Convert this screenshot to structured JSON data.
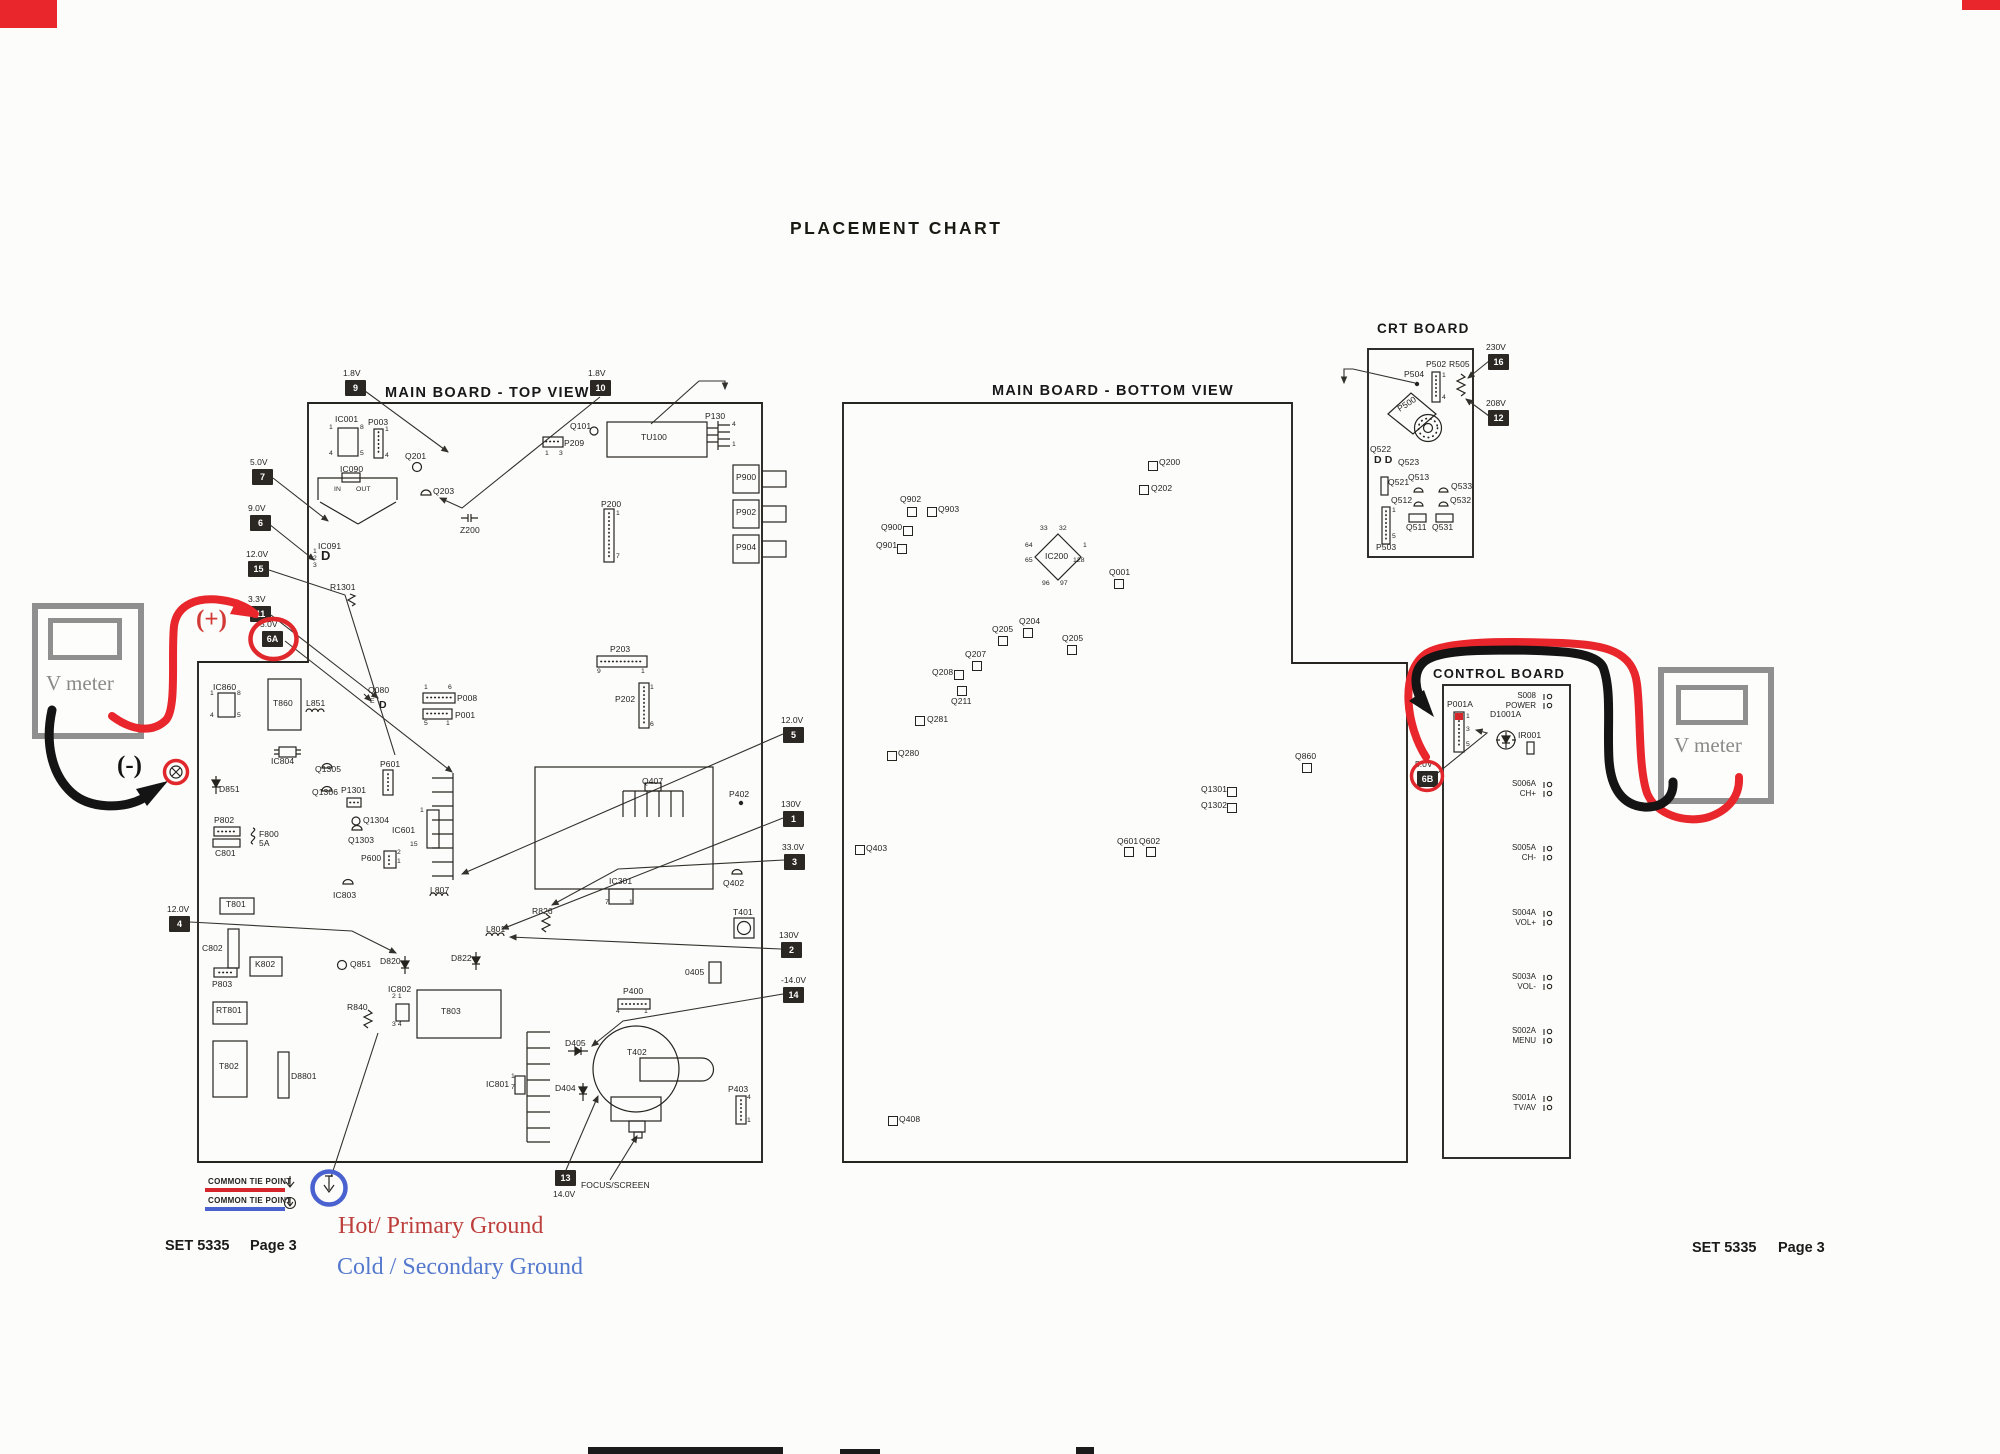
{
  "page": {
    "title": "PLACEMENT CHART",
    "annotations": {
      "plus": "(+)",
      "minus": "(-)"
    },
    "v_meters": {
      "left": "V meter",
      "right": "V meter"
    },
    "legend": {
      "common_tie_hot": "COMMON TIE POINT",
      "common_tie_cold": "COMMON TIE POINT",
      "hot_ground": "Hot/ Primary Ground",
      "cold_ground": "Cold / Secondary Ground"
    },
    "footer_left": {
      "set": "SET 5335",
      "page": "Page 3"
    },
    "footer_right": {
      "set": "SET 5335",
      "page": "Page 3"
    }
  },
  "colors": {
    "red": "#e0282c",
    "blue": "#4a62cf",
    "ink": "#26241f",
    "gray": "#8f8f8f"
  },
  "test_points": [
    {
      "id": "9",
      "v": "1.8V",
      "x": 345,
      "y": 380
    },
    {
      "id": "10",
      "v": "1.8V",
      "x": 590,
      "y": 380
    },
    {
      "id": "7",
      "v": "5.0V",
      "x": 252,
      "y": 469
    },
    {
      "id": "6",
      "v": "9.0V",
      "x": 250,
      "y": 515
    },
    {
      "id": "15",
      "v": "12.0V",
      "x": 248,
      "y": 561
    },
    {
      "id": "11",
      "v": "3.3V",
      "x": 250,
      "y": 606
    },
    {
      "id": "6A",
      "v": "5.0V",
      "x": 262,
      "y": 631
    },
    {
      "id": "4",
      "v": "12.0V",
      "x": 169,
      "y": 916
    },
    {
      "id": "5",
      "v": "12.0V",
      "x": 783,
      "y": 727
    },
    {
      "id": "1",
      "v": "130V",
      "x": 783,
      "y": 811
    },
    {
      "id": "3",
      "v": "33.0V",
      "x": 784,
      "y": 854
    },
    {
      "id": "2",
      "v": "130V",
      "x": 781,
      "y": 942
    },
    {
      "id": "14",
      "v": "-14.0V",
      "x": 783,
      "y": 987
    },
    {
      "id": "13",
      "v": "14.0V",
      "x": 555,
      "y": 1170,
      "below": true
    },
    {
      "id": "16",
      "v": "230V",
      "x": 1488,
      "y": 354
    },
    {
      "id": "12",
      "v": "208V",
      "x": 1488,
      "y": 410
    },
    {
      "id": "6B",
      "v": "5.0V",
      "x": 1417,
      "y": 771
    }
  ],
  "top_board": {
    "title": "MAIN BOARD - TOP VIEW",
    "labels": [
      {
        "t": "IC001",
        "x": 335,
        "y": 415
      },
      {
        "t": "P003",
        "x": 368,
        "y": 418
      },
      {
        "t": "IC090",
        "x": 340,
        "y": 465
      },
      {
        "t": "IN",
        "x": 334,
        "y": 486,
        "c": "pin"
      },
      {
        "t": "OUT",
        "x": 356,
        "y": 486,
        "c": "pin"
      },
      {
        "t": "Q201",
        "x": 405,
        "y": 452
      },
      {
        "t": "Q203",
        "x": 433,
        "y": 487
      },
      {
        "t": "Z200",
        "x": 460,
        "y": 526
      },
      {
        "t": "IC091",
        "x": 318,
        "y": 542
      },
      {
        "t": "D",
        "x": 321,
        "y": 549,
        "c": "d13"
      },
      {
        "t": "Q101",
        "x": 570,
        "y": 422
      },
      {
        "t": "P209",
        "x": 564,
        "y": 439
      },
      {
        "t": "TU100",
        "x": 641,
        "y": 433
      },
      {
        "t": "P130",
        "x": 705,
        "y": 412
      },
      {
        "t": "P900",
        "x": 736,
        "y": 473
      },
      {
        "t": "P902",
        "x": 736,
        "y": 508
      },
      {
        "t": "P904",
        "x": 736,
        "y": 543
      },
      {
        "t": "P200",
        "x": 601,
        "y": 500
      },
      {
        "t": "P203",
        "x": 610,
        "y": 645
      },
      {
        "t": "P202",
        "x": 615,
        "y": 695
      },
      {
        "t": "P008",
        "x": 457,
        "y": 694
      },
      {
        "t": "P001",
        "x": 455,
        "y": 711
      },
      {
        "t": "Q080",
        "x": 368,
        "y": 686
      },
      {
        "t": "D",
        "x": 379,
        "y": 700,
        "c": "d11"
      },
      {
        "t": "E",
        "x": 370,
        "y": 698,
        "c": "pin"
      },
      {
        "t": "R1301",
        "x": 330,
        "y": 583
      },
      {
        "t": "IC860",
        "x": 213,
        "y": 683
      },
      {
        "t": "T860",
        "x": 273,
        "y": 699
      },
      {
        "t": "L851",
        "x": 306,
        "y": 699
      },
      {
        "t": "IC804",
        "x": 271,
        "y": 757
      },
      {
        "t": "Q1305",
        "x": 315,
        "y": 765
      },
      {
        "t": "Q1306",
        "x": 312,
        "y": 788
      },
      {
        "t": "P1301",
        "x": 341,
        "y": 786
      },
      {
        "t": "Q1304",
        "x": 363,
        "y": 816
      },
      {
        "t": "Q1303",
        "x": 348,
        "y": 836
      },
      {
        "t": "IC601",
        "x": 392,
        "y": 826
      },
      {
        "t": "P601",
        "x": 380,
        "y": 760
      },
      {
        "t": "P600",
        "x": 361,
        "y": 854
      },
      {
        "t": "IC803",
        "x": 333,
        "y": 891
      },
      {
        "t": "L807",
        "x": 430,
        "y": 886
      },
      {
        "t": "T801",
        "x": 226,
        "y": 900
      },
      {
        "t": "D851",
        "x": 219,
        "y": 785
      },
      {
        "t": "P802",
        "x": 214,
        "y": 816
      },
      {
        "t": "F800",
        "x": 259,
        "y": 830
      },
      {
        "t": "5A",
        "x": 259,
        "y": 839
      },
      {
        "t": "C801",
        "x": 215,
        "y": 849
      },
      {
        "t": "C802",
        "x": 202,
        "y": 944
      },
      {
        "t": "K802",
        "x": 255,
        "y": 960
      },
      {
        "t": "P803",
        "x": 212,
        "y": 980
      },
      {
        "t": "RT801",
        "x": 216,
        "y": 1006
      },
      {
        "t": "T802",
        "x": 219,
        "y": 1062
      },
      {
        "t": "D8801",
        "x": 291,
        "y": 1072
      },
      {
        "t": "Q851",
        "x": 350,
        "y": 960
      },
      {
        "t": "D820",
        "x": 380,
        "y": 957
      },
      {
        "t": "D822",
        "x": 451,
        "y": 954
      },
      {
        "t": "IC802",
        "x": 388,
        "y": 985
      },
      {
        "t": "T803",
        "x": 441,
        "y": 1007
      },
      {
        "t": "R840",
        "x": 347,
        "y": 1003
      },
      {
        "t": "L801",
        "x": 486,
        "y": 925
      },
      {
        "t": "R826",
        "x": 532,
        "y": 907
      },
      {
        "t": "IC801",
        "x": 486,
        "y": 1080
      },
      {
        "t": "D404",
        "x": 555,
        "y": 1084
      },
      {
        "t": "D405",
        "x": 565,
        "y": 1039
      },
      {
        "t": "T402",
        "x": 627,
        "y": 1048
      },
      {
        "t": "P400",
        "x": 623,
        "y": 987
      },
      {
        "t": "P403",
        "x": 728,
        "y": 1085
      },
      {
        "t": "0405",
        "x": 685,
        "y": 968
      },
      {
        "t": "Q402",
        "x": 723,
        "y": 879
      },
      {
        "t": "Q407",
        "x": 642,
        "y": 777
      },
      {
        "t": "IC301",
        "x": 609,
        "y": 877
      },
      {
        "t": "P402",
        "x": 729,
        "y": 790
      },
      {
        "t": "T401",
        "x": 733,
        "y": 908
      },
      {
        "t": "FOCUS/SCREEN",
        "x": 581,
        "y": 1181
      }
    ],
    "pins": [
      {
        "t": "1",
        "x": 329,
        "y": 424
      },
      {
        "t": "8",
        "x": 360,
        "y": 424
      },
      {
        "t": "4",
        "x": 329,
        "y": 450
      },
      {
        "t": "5",
        "x": 360,
        "y": 450
      },
      {
        "t": "1",
        "x": 385,
        "y": 426
      },
      {
        "t": "4",
        "x": 385,
        "y": 452
      },
      {
        "t": "1",
        "x": 313,
        "y": 548
      },
      {
        "t": "2",
        "x": 313,
        "y": 555
      },
      {
        "t": "3",
        "x": 313,
        "y": 562
      },
      {
        "t": "1",
        "x": 545,
        "y": 450
      },
      {
        "t": "3",
        "x": 559,
        "y": 450
      },
      {
        "t": "4",
        "x": 732,
        "y": 421
      },
      {
        "t": "1",
        "x": 732,
        "y": 441
      },
      {
        "t": "1",
        "x": 616,
        "y": 510
      },
      {
        "t": "7",
        "x": 616,
        "y": 553
      },
      {
        "t": "9",
        "x": 597,
        "y": 668
      },
      {
        "t": "1",
        "x": 641,
        "y": 668
      },
      {
        "t": "1",
        "x": 650,
        "y": 684
      },
      {
        "t": "6",
        "x": 650,
        "y": 721
      },
      {
        "t": "1",
        "x": 424,
        "y": 684
      },
      {
        "t": "6",
        "x": 448,
        "y": 684
      },
      {
        "t": "5",
        "x": 424,
        "y": 720
      },
      {
        "t": "1",
        "x": 446,
        "y": 720
      },
      {
        "t": "1",
        "x": 210,
        "y": 690
      },
      {
        "t": "8",
        "x": 237,
        "y": 690
      },
      {
        "t": "4",
        "x": 210,
        "y": 712
      },
      {
        "t": "5",
        "x": 237,
        "y": 712
      },
      {
        "t": "1",
        "x": 420,
        "y": 807
      },
      {
        "t": "15",
        "x": 410,
        "y": 841
      },
      {
        "t": "2",
        "x": 397,
        "y": 849
      },
      {
        "t": "1",
        "x": 397,
        "y": 858
      },
      {
        "t": "2 1",
        "x": 392,
        "y": 993
      },
      {
        "t": "3 4",
        "x": 392,
        "y": 1021
      },
      {
        "t": "1",
        "x": 511,
        "y": 1073
      },
      {
        "t": "7",
        "x": 511,
        "y": 1084
      },
      {
        "t": "7",
        "x": 605,
        "y": 899
      },
      {
        "t": "1",
        "x": 629,
        "y": 899
      },
      {
        "t": "4",
        "x": 616,
        "y": 1008
      },
      {
        "t": "1",
        "x": 644,
        "y": 1008
      },
      {
        "t": "4",
        "x": 747,
        "y": 1094
      },
      {
        "t": "1",
        "x": 747,
        "y": 1117
      }
    ]
  },
  "bottom_board": {
    "title": "MAIN BOARD - BOTTOM VIEW",
    "parts": [
      {
        "t": "Q200",
        "sx": 1148,
        "sy": 461,
        "lx": 1159,
        "ly": 458
      },
      {
        "t": "Q202",
        "sx": 1139,
        "sy": 485,
        "lx": 1151,
        "ly": 484
      },
      {
        "t": "Q902",
        "sx": 907,
        "sy": 507,
        "lx": 900,
        "ly": 495
      },
      {
        "t": "Q903",
        "sx": 927,
        "sy": 507,
        "lx": 938,
        "ly": 505
      },
      {
        "t": "Q900",
        "sx": 903,
        "sy": 526,
        "lx": 881,
        "ly": 523
      },
      {
        "t": "Q901",
        "sx": 897,
        "sy": 544,
        "lx": 876,
        "ly": 541
      },
      {
        "t": "Q001",
        "sx": 1114,
        "sy": 579,
        "lx": 1109,
        "ly": 568
      },
      {
        "t": "Q204",
        "sx": 1023,
        "sy": 628,
        "lx": 1019,
        "ly": 617
      },
      {
        "t": "Q205",
        "sx": 998,
        "sy": 636,
        "lx": 992,
        "ly": 625
      },
      {
        "t": "Q205",
        "sx": 1067,
        "sy": 645,
        "lx": 1062,
        "ly": 634
      },
      {
        "t": "Q207",
        "sx": 972,
        "sy": 661,
        "lx": 965,
        "ly": 650
      },
      {
        "t": "Q208",
        "sx": 954,
        "sy": 670,
        "lx": 932,
        "ly": 668
      },
      {
        "t": "Q211",
        "sx": 957,
        "sy": 686,
        "lx": 951,
        "ly": 697
      },
      {
        "t": "Q281",
        "sx": 915,
        "sy": 716,
        "lx": 927,
        "ly": 715
      },
      {
        "t": "Q280",
        "sx": 887,
        "sy": 751,
        "lx": 898,
        "ly": 749
      },
      {
        "t": "Q860",
        "sx": 1302,
        "sy": 763,
        "lx": 1295,
        "ly": 752
      },
      {
        "t": "Q1301",
        "sx": 1227,
        "sy": 787,
        "lx": 1201,
        "ly": 785
      },
      {
        "t": "Q1302",
        "sx": 1227,
        "sy": 803,
        "lx": 1201,
        "ly": 801
      },
      {
        "t": "Q601",
        "sx": 1124,
        "sy": 847,
        "lx": 1117,
        "ly": 837
      },
      {
        "t": "Q602",
        "sx": 1146,
        "sy": 847,
        "lx": 1139,
        "ly": 837
      },
      {
        "t": "Q403",
        "sx": 855,
        "sy": 845,
        "lx": 866,
        "ly": 844
      },
      {
        "t": "Q408",
        "sx": 888,
        "sy": 1116,
        "lx": 899,
        "ly": 1115
      }
    ],
    "ic200": {
      "label": {
        "t": "IC200",
        "x": 1045,
        "y": 552
      },
      "pins": [
        {
          "t": "33",
          "x": 1040,
          "y": 525
        },
        {
          "t": "32",
          "x": 1059,
          "y": 525
        },
        {
          "t": "64",
          "x": 1025,
          "y": 542
        },
        {
          "t": "65",
          "x": 1025,
          "y": 557
        },
        {
          "t": "1",
          "x": 1083,
          "y": 542
        },
        {
          "t": "128",
          "x": 1073,
          "y": 557
        },
        {
          "t": "96",
          "x": 1042,
          "y": 580
        },
        {
          "t": "97",
          "x": 1060,
          "y": 580
        }
      ]
    }
  },
  "crt_board": {
    "title": "CRT BOARD",
    "labels": [
      {
        "t": "P504",
        "x": 1404,
        "y": 370
      },
      {
        "t": "P502",
        "x": 1426,
        "y": 360
      },
      {
        "t": "R505",
        "x": 1449,
        "y": 360
      },
      {
        "t": "P500",
        "x": 1396,
        "y": 406,
        "c": "rot"
      },
      {
        "t": "Q522",
        "x": 1370,
        "y": 445
      },
      {
        "t": "D D",
        "x": 1374,
        "y": 455,
        "c": "d11"
      },
      {
        "t": "Q523",
        "x": 1398,
        "y": 458
      },
      {
        "t": "Q521",
        "x": 1388,
        "y": 478
      },
      {
        "t": "Q513",
        "x": 1408,
        "y": 473
      },
      {
        "t": "Q533",
        "x": 1451,
        "y": 482
      },
      {
        "t": "Q512",
        "x": 1391,
        "y": 496
      },
      {
        "t": "Q532",
        "x": 1450,
        "y": 496
      },
      {
        "t": "Q511",
        "x": 1406,
        "y": 523
      },
      {
        "t": "Q531",
        "x": 1432,
        "y": 523
      },
      {
        "t": "P503",
        "x": 1376,
        "y": 543
      }
    ],
    "pins": [
      {
        "t": "1",
        "x": 1442,
        "y": 372
      },
      {
        "t": "4",
        "x": 1442,
        "y": 394
      },
      {
        "t": "1",
        "x": 1392,
        "y": 507
      },
      {
        "t": "5",
        "x": 1392,
        "y": 533
      }
    ]
  },
  "control_board": {
    "title": "CONTROL BOARD",
    "labels": [
      {
        "t": "P001A",
        "x": 1447,
        "y": 700
      },
      {
        "t": "D1001A",
        "x": 1490,
        "y": 710
      },
      {
        "t": "IR001",
        "x": 1518,
        "y": 731
      }
    ],
    "pins": [
      {
        "t": "1",
        "x": 1466,
        "y": 713
      },
      {
        "t": "3",
        "x": 1466,
        "y": 726
      },
      {
        "t": "5",
        "x": 1466,
        "y": 741
      }
    ],
    "switches": [
      {
        "name": "S008",
        "func": "POWER",
        "y": 691
      },
      {
        "name": "S006A",
        "func": "CH+",
        "y": 779
      },
      {
        "name": "S005A",
        "func": "CH-",
        "y": 843
      },
      {
        "name": "S004A",
        "func": "VOL+",
        "y": 908
      },
      {
        "name": "S003A",
        "func": "VOL-",
        "y": 972
      },
      {
        "name": "S002A",
        "func": "MENU",
        "y": 1026
      },
      {
        "name": "S001A",
        "func": "TV/AV",
        "y": 1093
      }
    ]
  }
}
